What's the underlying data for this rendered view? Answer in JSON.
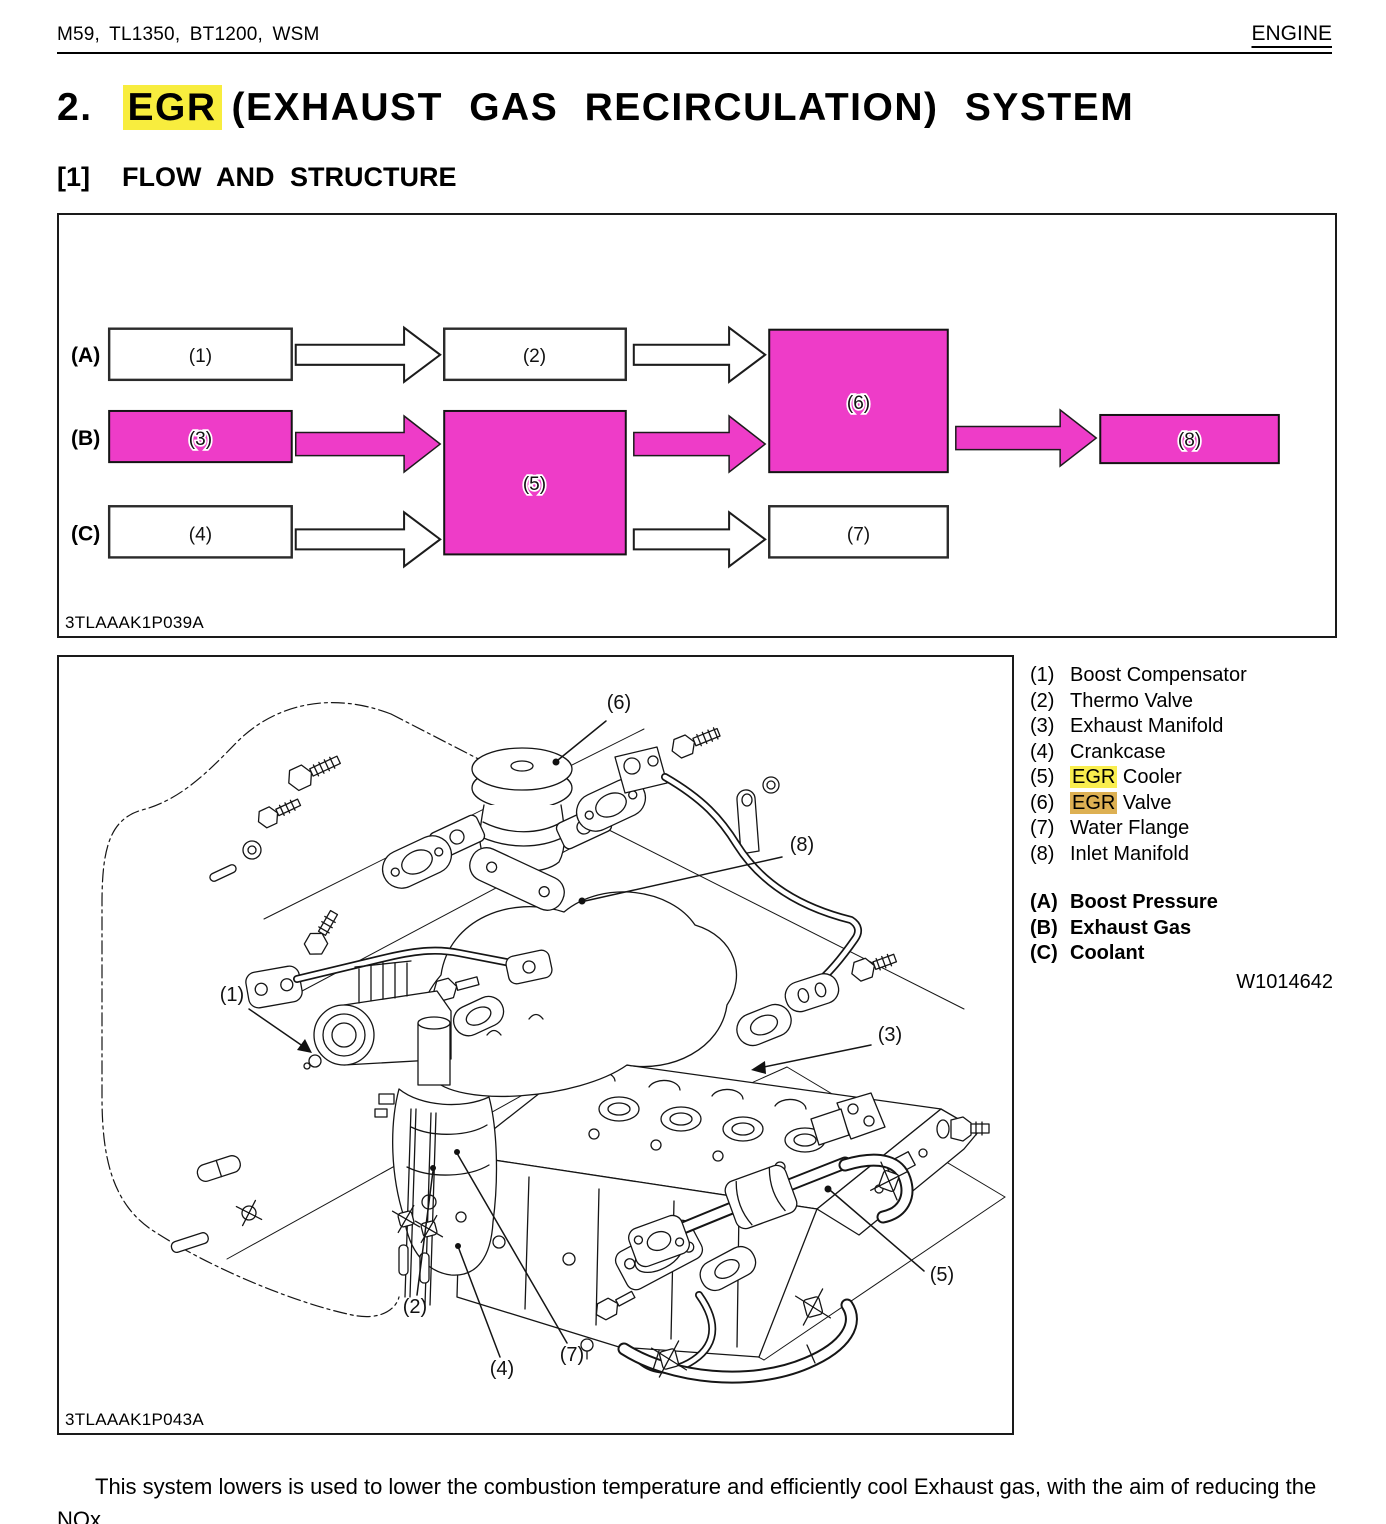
{
  "header": {
    "left": "M59,  TL1350,  BT1200, WSM",
    "right": "ENGINE"
  },
  "title": {
    "number": "2.",
    "highlighted": "EGR",
    "rest": "(EXHAUST GAS RECIRCULATION) SYSTEM",
    "highlight_color": "#f8ed3e"
  },
  "section": {
    "index": "[1]",
    "label": "FLOW AND STRUCTURE"
  },
  "flow_diagram": {
    "caption": "3TLAAAK1P039A",
    "row_labels": {
      "a": "(A)",
      "b": "(B)",
      "c": "(C)"
    },
    "boxes": {
      "box1": "(1)",
      "box2": "(2)",
      "box3": "(3)",
      "box4": "(4)",
      "box5": "(5)",
      "box6": "(6)",
      "box7": "(7)",
      "box8": "(8)"
    },
    "colors": {
      "magenta": "#ee3cc8",
      "box_border": "#1a1a1a"
    }
  },
  "engine_figure": {
    "caption": "3TLAAAK1P043A",
    "callouts": {
      "c1": "(1)",
      "c2": "(2)",
      "c3": "(3)",
      "c4": "(4)",
      "c5": "(5)",
      "c6": "(6)",
      "c7": "(7)",
      "c8": "(8)"
    }
  },
  "legend": {
    "items": [
      {
        "num": "(1)",
        "text": "Boost Compensator"
      },
      {
        "num": "(2)",
        "text": "Thermo Valve"
      },
      {
        "num": "(3)",
        "text": "Exhaust Manifold"
      },
      {
        "num": "(4)",
        "text": "Crankcase"
      },
      {
        "num": "(5)",
        "hl": "EGR",
        "text": " Cooler"
      },
      {
        "num": "(6)",
        "hl": "EGR",
        "text": " Valve"
      },
      {
        "num": "(7)",
        "text": "Water Flange"
      },
      {
        "num": "(8)",
        "text": "Inlet Manifold"
      }
    ],
    "flows": [
      {
        "key": "(A)",
        "label": "Boost Pressure"
      },
      {
        "key": "(B)",
        "label": "Exhaust Gas"
      },
      {
        "key": "(C)",
        "label": "Coolant"
      }
    ],
    "ref_code": "W1014642",
    "highlight_yellow": "#f9ee4e",
    "highlight_amber": "#ddb053"
  },
  "body_text": "This system lowers is used to lower the combustion temperature and efficiently cool Exhaust gas, with the aim of reducing the NOx."
}
